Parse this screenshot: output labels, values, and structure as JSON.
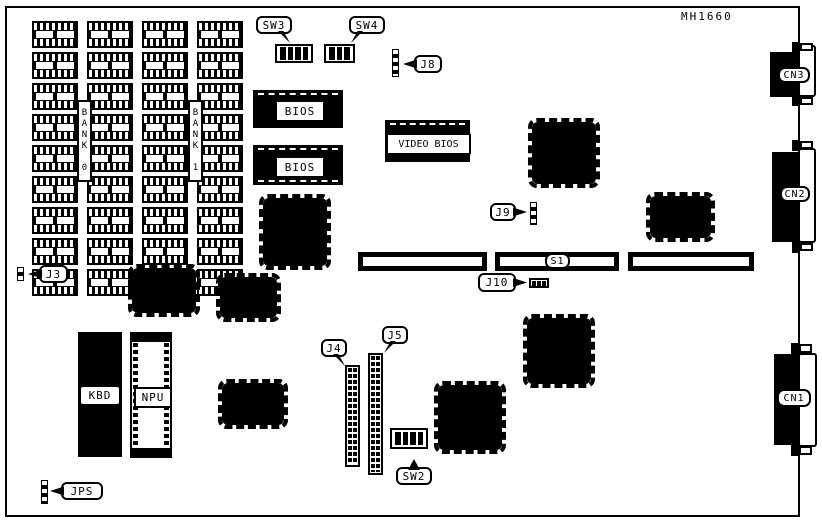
{
  "board": {
    "part_number": "MH1660",
    "memory": {
      "rows": 9,
      "columns": 4,
      "bank0_label": "BANK 0",
      "bank1_label": "BANK 1"
    },
    "chips": {
      "bios1_label": "BIOS",
      "bios2_label": "BIOS",
      "video_bios_label": "VIDEO BIOS",
      "kbd_label": "KBD",
      "npu_label": "NPU"
    },
    "switches": {
      "sw2": {
        "label": "SW2",
        "positions": 4
      },
      "sw3": {
        "label": "SW3",
        "positions": 4
      },
      "sw4": {
        "label": "SW4",
        "positions": 3
      }
    },
    "connectors": {
      "cn1": {
        "label": "CN1"
      },
      "cn2": {
        "label": "CN2"
      },
      "cn3": {
        "label": "CN3"
      },
      "s1": {
        "label": "S1"
      },
      "j3": {
        "label": "J3"
      },
      "j4": {
        "label": "J4"
      },
      "j5": {
        "label": "J5"
      },
      "j8": {
        "label": "J8"
      },
      "j9": {
        "label": "J9"
      },
      "j10": {
        "label": "J10",
        "positions": 3
      },
      "jps": {
        "label": "JPS"
      }
    },
    "colors": {
      "ink": "#000000",
      "paper": "#ffffff"
    }
  }
}
